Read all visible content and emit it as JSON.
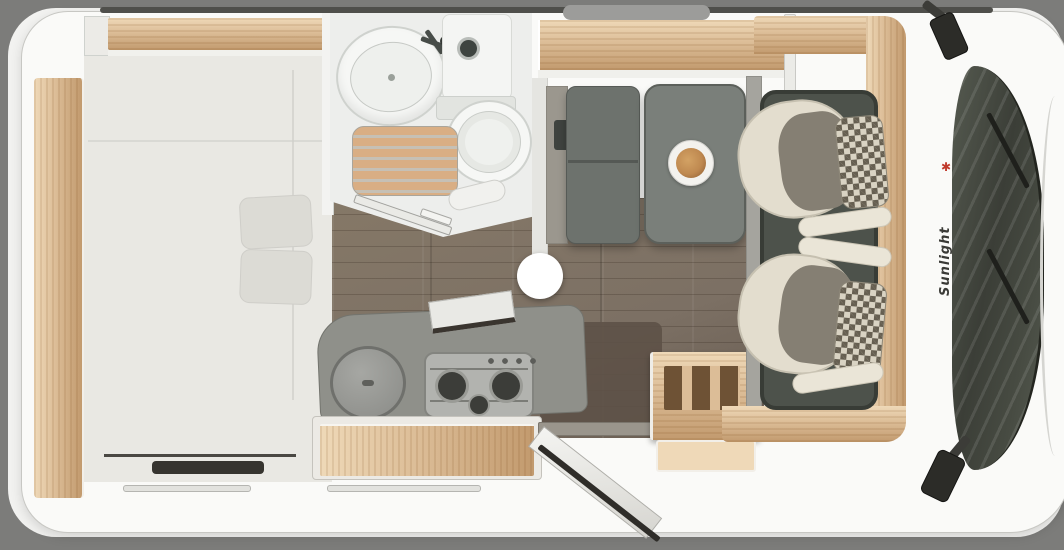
{
  "meta": {
    "description": "Top-down 3D floor plan rendering of a Sunlight motorhome interior with swivelled cab seats, dinette, kitchen, bathroom and rear bed",
    "view": "overhead-floorplan"
  },
  "brand": {
    "label": "Sunlight",
    "mark": "✱"
  },
  "hotspot": {
    "kind": "panorama-viewpoint-marker"
  },
  "furniture": [
    "rear-bed",
    "wardrobe-shelf",
    "bathroom-sink",
    "shower-duckboard",
    "toilet",
    "dinette-bench",
    "dinette-table",
    "dinner-plate",
    "kitchen-round-sink",
    "gas-hob-3-burner",
    "kitchen-drawers",
    "entry-door-open",
    "bottle-rack-cabinet",
    "driver-seat",
    "passenger-seat",
    "cab-floor-mat",
    "windshield",
    "wipers",
    "side-mirror-left",
    "side-mirror-right",
    "roof-vent"
  ],
  "colors": {
    "page_bg": "#7c7c7a",
    "card_bg": "#f2f2f0",
    "body_white": "#fafaf8",
    "body_line": "#c7c7c3",
    "roofline": "#4f4f4b",
    "vent_gray": "#9c9c9a",
    "wood": "#dcbd97",
    "wood_light": "#efd9b8",
    "wood_dark": "#c29a6e",
    "bed_white": "#e9e8e3",
    "linen": "#dcdbd5",
    "linen_line": "#cfcec9",
    "heater_dark": "#36342f",
    "bath_white": "#edeeec",
    "fixture_white": "#f6f7f5",
    "fixture_line": "#cfd2ce",
    "knob_dark": "#3e4440",
    "duck_base": "#c6c0b5",
    "duck_slat": "#d9ae84",
    "floor": "#7c7064",
    "floor_dark": "#5d5147",
    "plank": "rgba(40,28,18,0.22)",
    "counter": "#8f908a",
    "counter_line": "#73746e",
    "steel": "#b2b3af",
    "steel_line": "#83847f",
    "burner": "#3c3d39",
    "bench": "#6d726d",
    "table": "#7a7f7a",
    "table_line": "#5c605b",
    "plate": "#f3f2ee",
    "food": "#bf8950",
    "food_dark": "#8a5a30",
    "mat": "#4d524b",
    "mat_line": "#383c36",
    "seat_cream": "#e3ddce",
    "seat_line": "#c6c0b0",
    "seat_gray": "#857f73",
    "check_light": "#d9d3c3",
    "check_dark": "#665f51",
    "glass": "#3b3e37",
    "glass_hi": "rgba(255,255,255,0.10)",
    "wiper": "#1f201c",
    "mirror": "#2c2c28",
    "door_edge": "#2f2d29",
    "hotspot": "#ffffff",
    "brand_red": "#c0392b",
    "brand_text": "#3a3a36"
  }
}
